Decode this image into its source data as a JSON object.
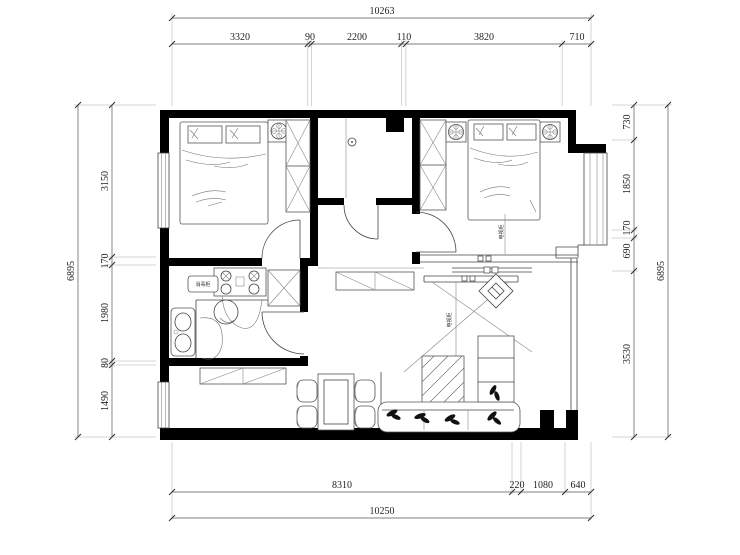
{
  "drawing": {
    "type": "apartment floor plan",
    "units": "mm"
  },
  "dimensions": {
    "top_total": "10263",
    "top_segments": [
      "3320",
      "90",
      "2200",
      "110",
      "3820",
      "710"
    ],
    "bottom_segments": [
      "8310",
      "220",
      "1080",
      "640"
    ],
    "bottom_total": "10250",
    "left_total": "6895",
    "left_segments": [
      "3150",
      "170",
      "1980",
      "80",
      "1490"
    ],
    "right_total": "6895",
    "right_segments": [
      "730",
      "1850",
      "170",
      "690",
      "3530"
    ]
  },
  "labels": {
    "appliance_box": "消毒柜",
    "master_tv_label": "电视柜",
    "living_tv_label": "电视柜"
  },
  "colors": {
    "wall": "#000000",
    "dimension_text": "#222222",
    "line": "#555555"
  }
}
